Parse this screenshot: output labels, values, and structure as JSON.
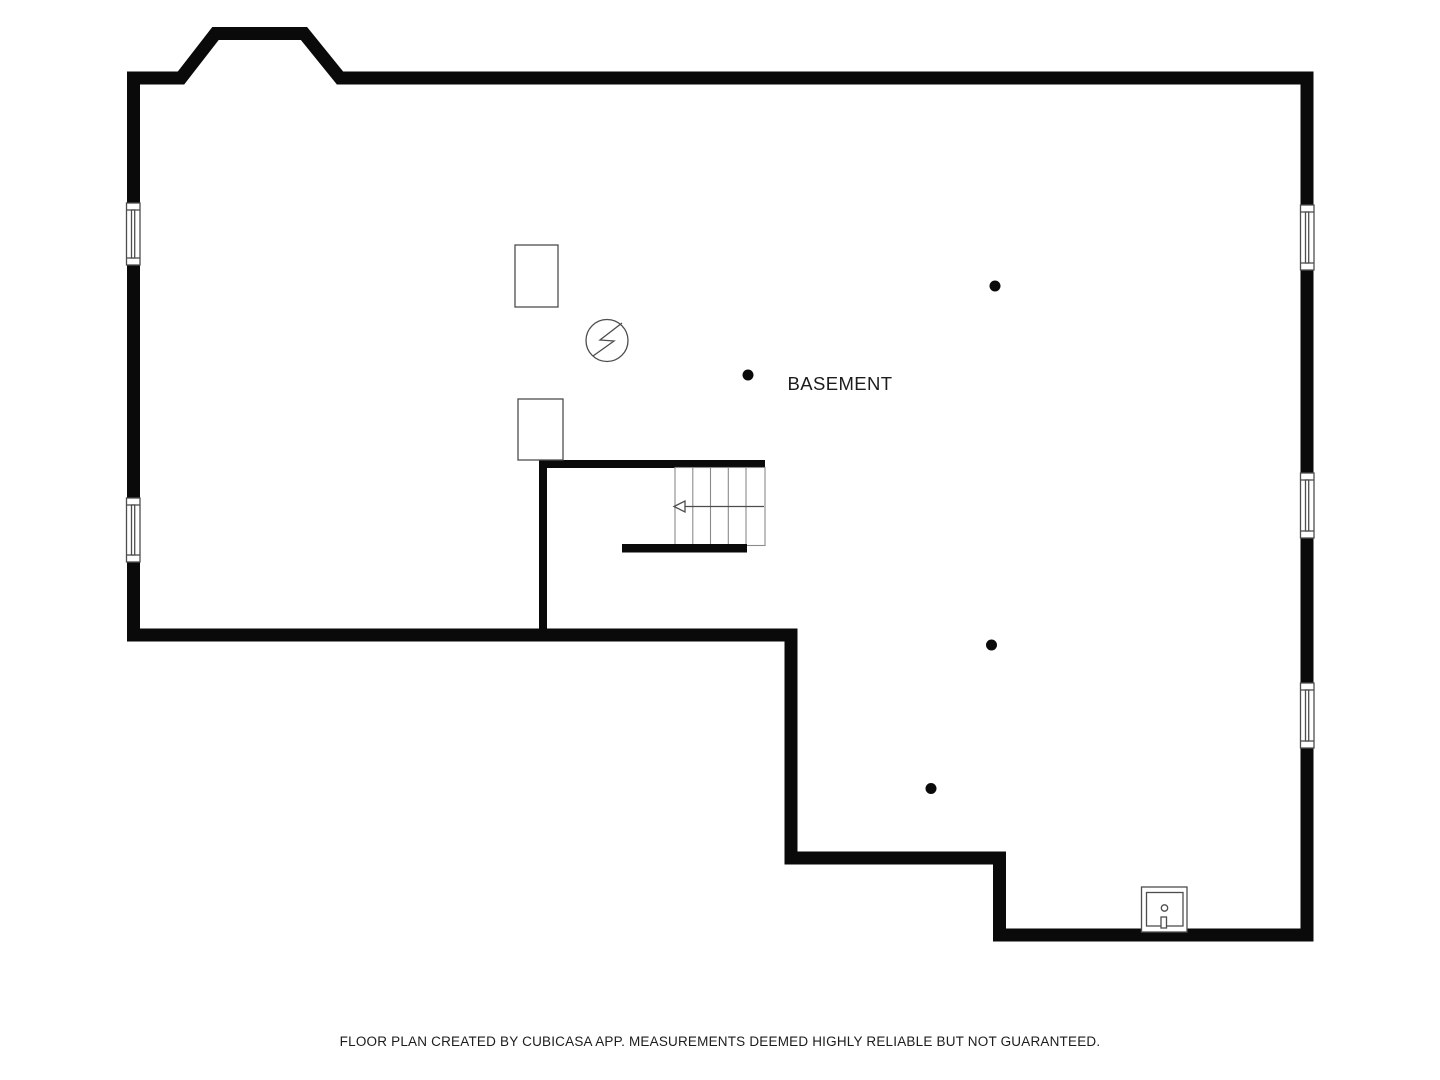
{
  "floor_plan": {
    "room_label": "BASEMENT",
    "footer_note": "FLOOR PLAN CREATED BY CUBICASA APP. MEASUREMENTS DEEMED HIGHLY RELIABLE BUT NOT GUARANTEED."
  },
  "symbols": {
    "window_count": 5,
    "support_post_count": 4,
    "appliance_box_count": 2,
    "staircase_symbol": "stairs-with-direction-arrow",
    "electrical_symbol": "electrical-panel-circle-bolt",
    "utility_symbol": "sump-pump-square"
  },
  "colors": {
    "background": "#ffffff",
    "wall": "#0a0a0a",
    "thin_line": "#4d4d4d",
    "light_line": "#8a8a8a",
    "text": "#1c1c1c"
  }
}
